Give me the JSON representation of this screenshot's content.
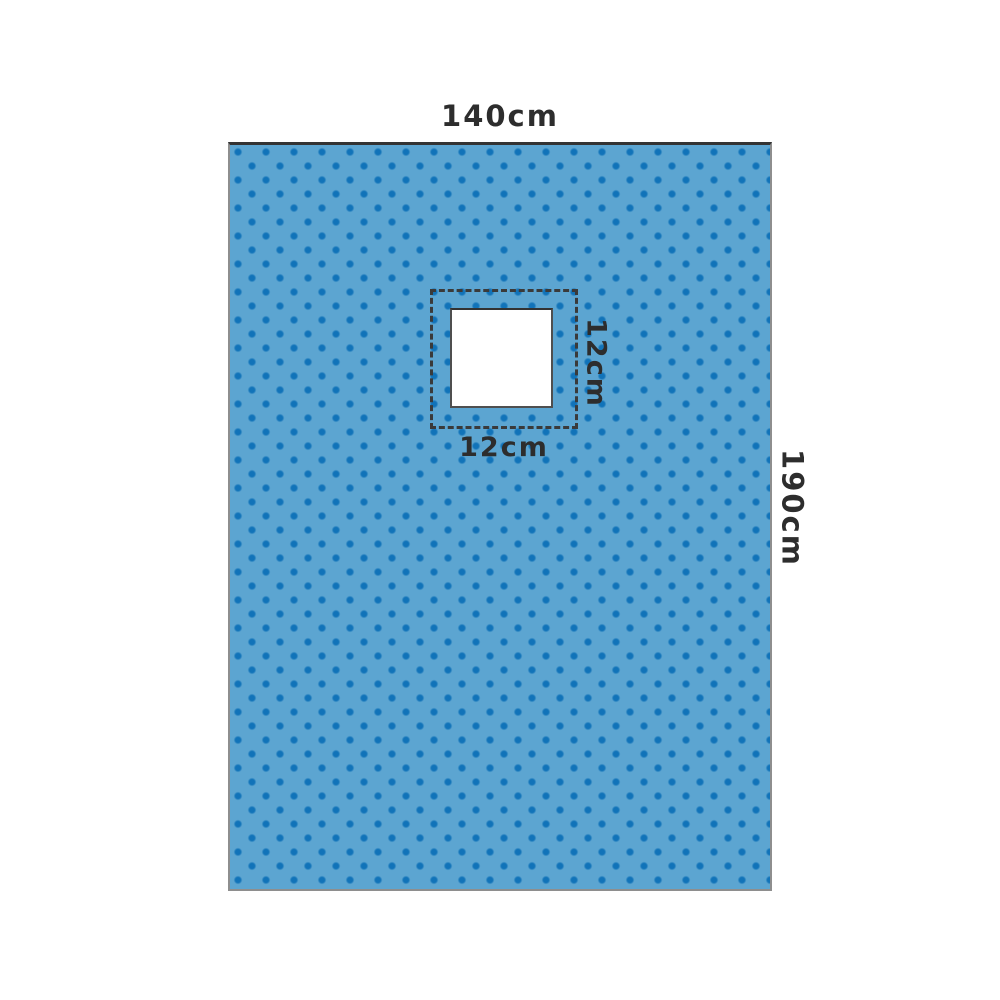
{
  "diagram": {
    "type": "surgical-drape-with-square-fenestration",
    "labels": {
      "drape_width": "140cm",
      "drape_height": "190cm",
      "fenestration_width": "12cm",
      "fenestration_height": "12cm"
    },
    "colors": {
      "fabric": "#5CA5D1",
      "dot": "#1173B9",
      "hole_fill": "#FFFFFF",
      "dashed_outline": "#3A3A3A",
      "drape_border_top": "#333333",
      "drape_border_side": "#8E8E8E",
      "label_text": "#2D2D2D",
      "background": "#FFFFFF"
    }
  }
}
